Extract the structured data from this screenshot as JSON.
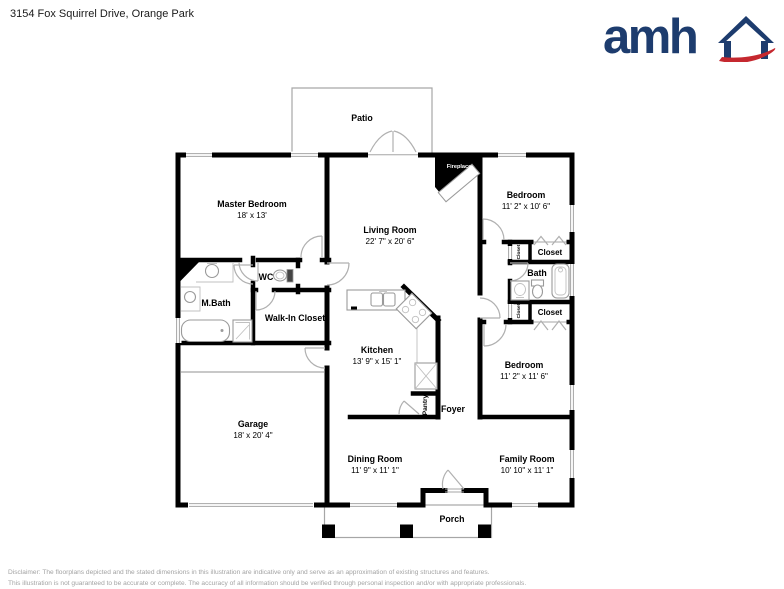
{
  "header": {
    "address": "3154 Fox Squirrel Drive, Orange Park"
  },
  "logo": {
    "text": "amh",
    "brand_blue": "#1d3c6e",
    "brand_red": "#c5282f"
  },
  "rooms": {
    "patio": {
      "name": "Patio"
    },
    "master_bedroom": {
      "name": "Master Bedroom",
      "dims": "18' x 13'"
    },
    "living_room": {
      "name": "Living Room",
      "dims": "22' 7\" x 20' 6\""
    },
    "fireplace": {
      "name": "Fireplace"
    },
    "bedroom_top": {
      "name": "Bedroom",
      "dims": "11' 2\" x 10' 6\""
    },
    "closet_top_small": {
      "name": "Closet"
    },
    "closet_top": {
      "name": "Closet"
    },
    "bath": {
      "name": "Bath"
    },
    "closet_bottom_small": {
      "name": "Closet"
    },
    "closet_bottom": {
      "name": "Closet"
    },
    "bedroom_bottom": {
      "name": "Bedroom",
      "dims": "11' 2\" x 11' 6\""
    },
    "wc": {
      "name": "WC"
    },
    "master_bath": {
      "name": "M.Bath"
    },
    "walk_in_closet": {
      "name": "Walk-In Closet"
    },
    "kitchen": {
      "name": "Kitchen",
      "dims": "13' 9\" x 15' 1\""
    },
    "pantry": {
      "name": "Pantry"
    },
    "foyer": {
      "name": "Foyer"
    },
    "garage": {
      "name": "Garage",
      "dims": "18' x 20' 4\""
    },
    "dining_room": {
      "name": "Dining Room",
      "dims": "11' 9\" x 11' 1\""
    },
    "family_room": {
      "name": "Family Room",
      "dims": "10' 10\" x 11' 1\""
    },
    "porch": {
      "name": "Porch"
    }
  },
  "footer": {
    "line1": "Disclaimer: The floorplans depicted and the stated dimensions in this illustration are indicative only and serve as an approximation of existing structures and features.",
    "line2": "This illustration is not guaranteed to be accurate or complete. The accuracy of all information should be verified through personal inspection and/or with appropriate professionals."
  }
}
